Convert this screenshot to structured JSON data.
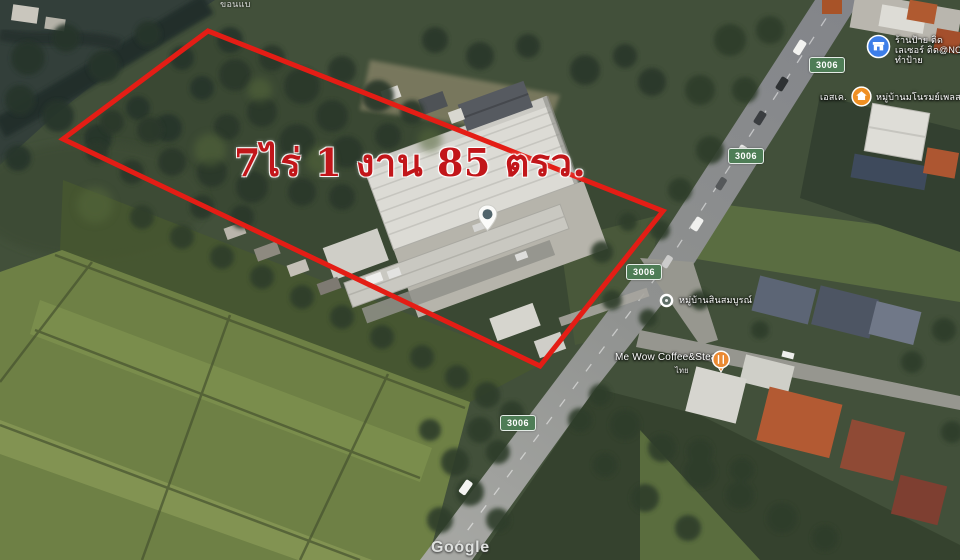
{
  "plot": {
    "area_label": "7ไร่ 1 งาน 85 ตรว.",
    "outline_color": "#e41d15"
  },
  "roads": {
    "route_badge": "3006",
    "badge_color": "#4e7d56"
  },
  "markers": {
    "sign_shop": {
      "line1": "ร้านป้าย ติด",
      "line2": "เลเซอร์ ติด@NC",
      "line3": "ทำป้าย",
      "icon_color": "#3d7ee8"
    },
    "village_manorom": {
      "prefix": "เอสเค.",
      "name": "หมู่บ้านมโนรมย์เพลส 2",
      "icon_color": "#ef8f23"
    },
    "village_sinsombun": {
      "name": "หมู่บ้านสินสมบูรณ์",
      "icon_color": "#5f6f68"
    },
    "restaurant": {
      "name": "Me Wow Coffee&Steak",
      "category": "ไทย",
      "icon_color": "#ea8a33"
    }
  },
  "labels": {
    "canal": "ขอนแบ"
  },
  "watermark": "Google"
}
